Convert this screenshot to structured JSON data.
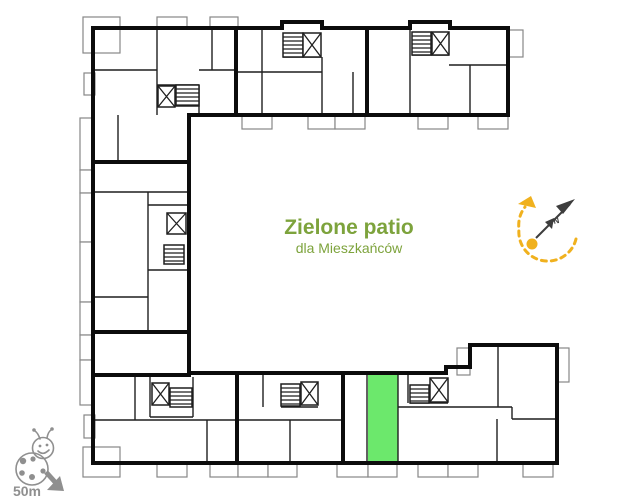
{
  "patio": {
    "title": "Zielone patio",
    "subtitle": "dla Mieszkańców"
  },
  "compass": {
    "north_label": "N"
  },
  "scale_indicator": {
    "label": "50m"
  },
  "plan": {
    "description": "C-shaped residential building floor plan around a green courtyard, open to the right",
    "highlighted_unit": "green apartment unit in bottom wing",
    "stair_cores": 7,
    "elevator_symbol": "box with X",
    "stairs_symbol": "hatched box"
  },
  "colors": {
    "walls": "#0c0c0c",
    "partitions": "#1f1f1f",
    "balcony": "#878787",
    "highlight_green": "#6ce86c",
    "olive": "#7da33c",
    "yellow": "#f0b11e",
    "gray": "#8f8f8f",
    "needle": "#3d3d3d"
  }
}
